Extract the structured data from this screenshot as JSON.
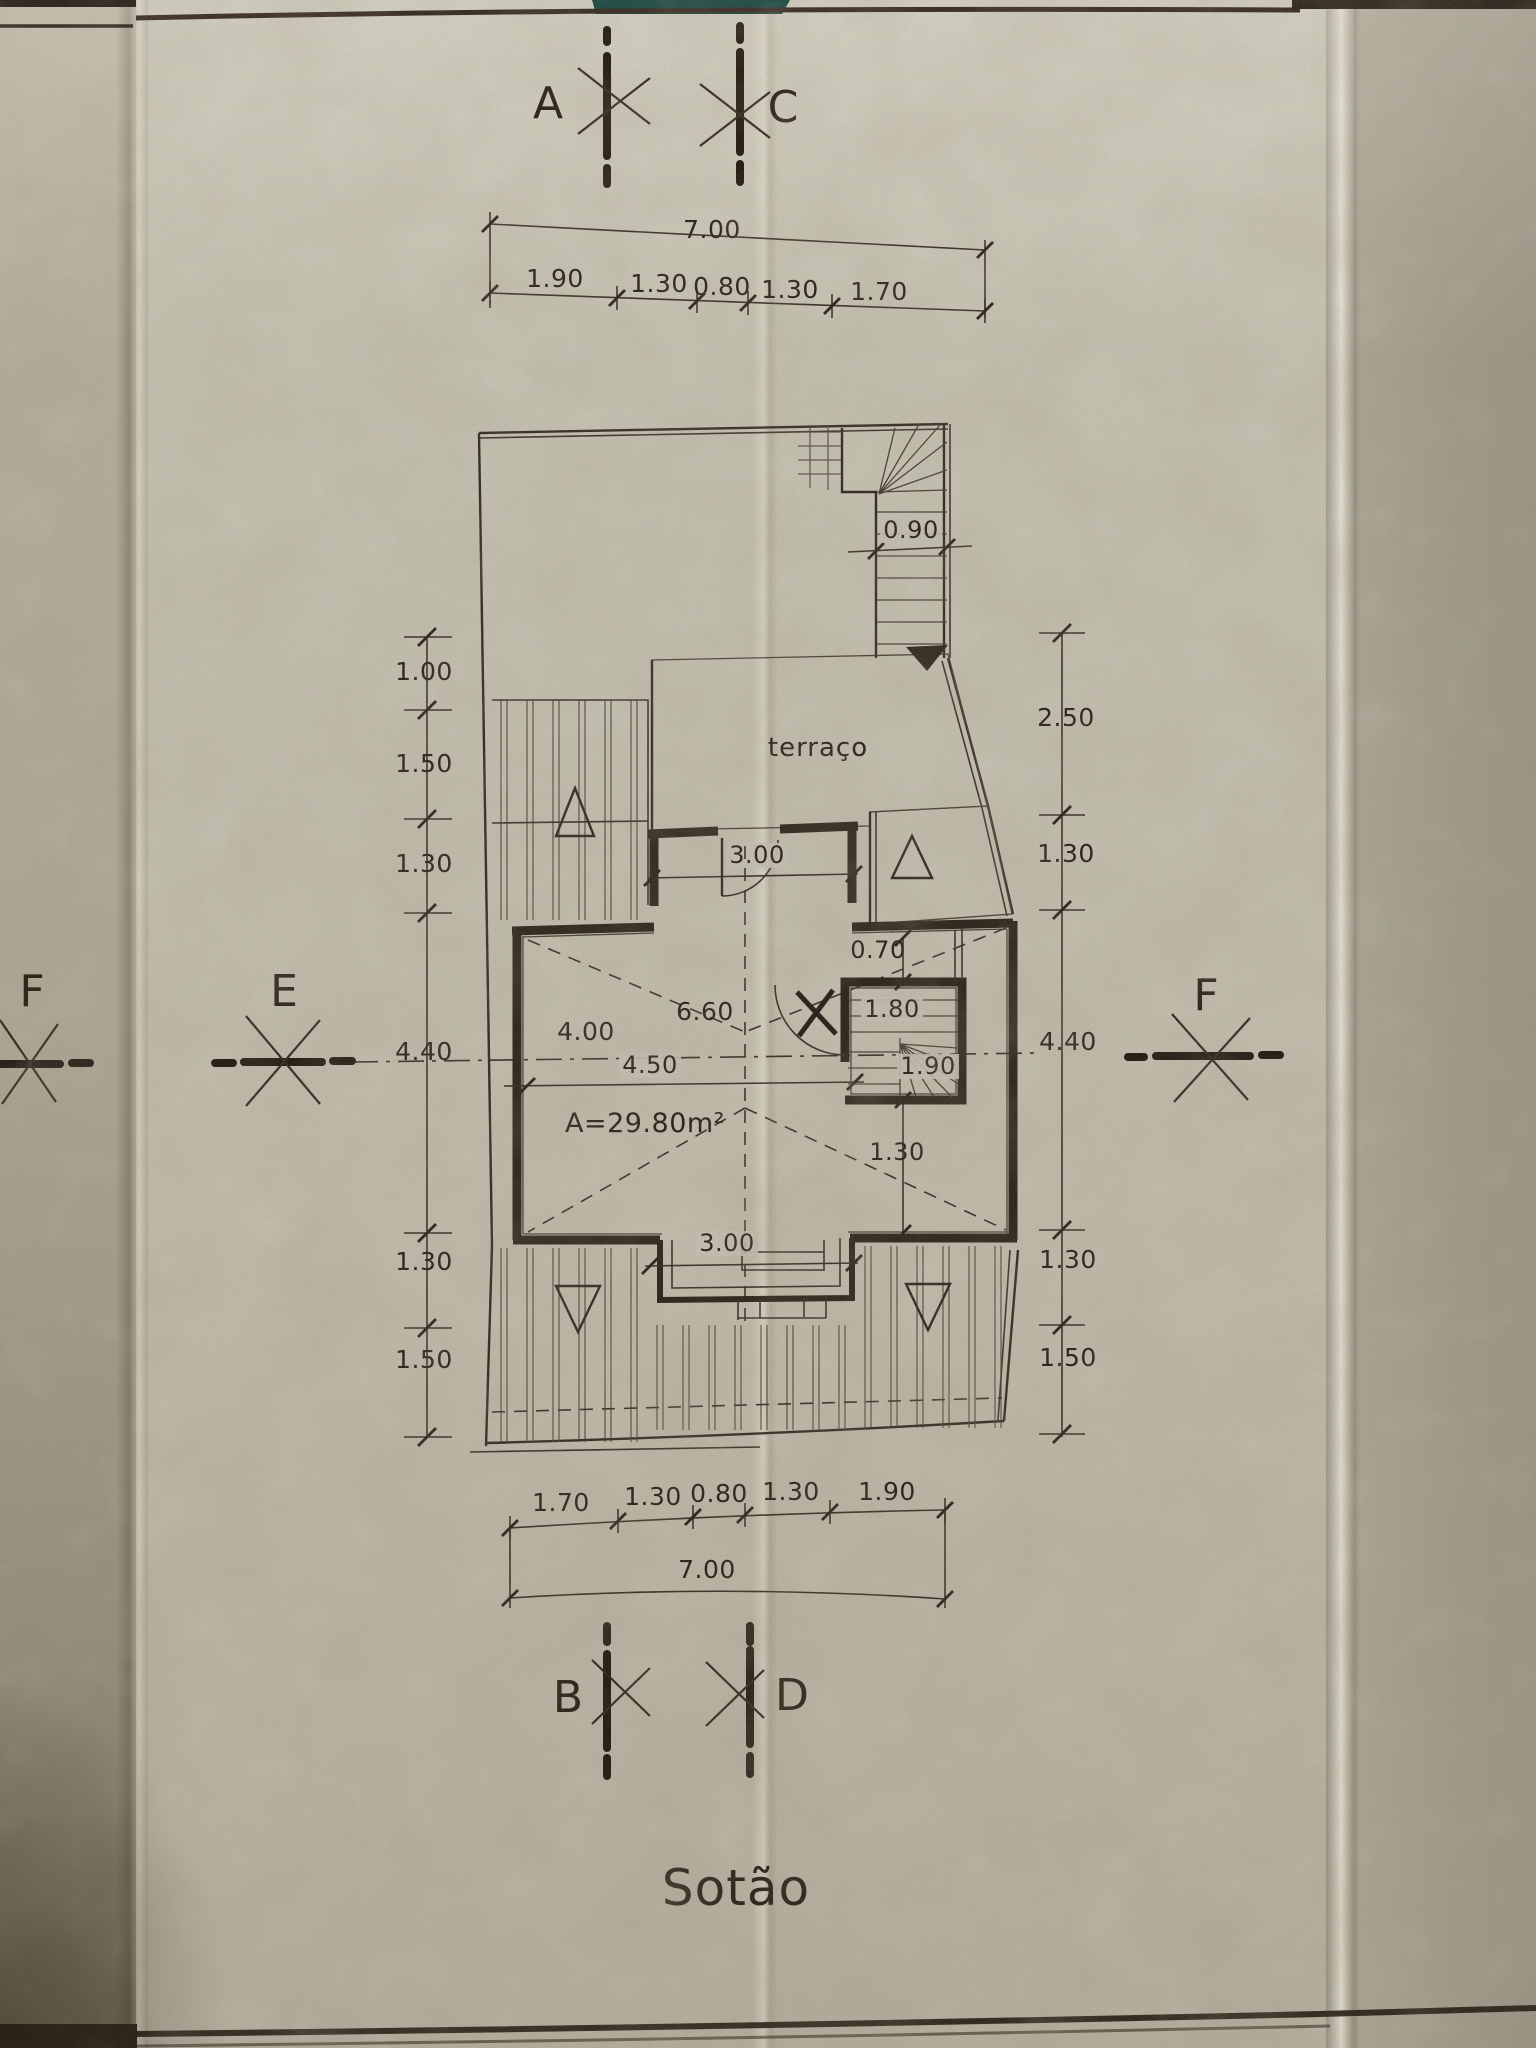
{
  "drawing": {
    "title": "Sotão",
    "markers": {
      "top_left": "A",
      "top_right": "C",
      "bottom_left": "B",
      "bottom_right": "D",
      "left_outer": "F",
      "left_inner": "E",
      "right": "F"
    },
    "dims_top": {
      "total": "7.00",
      "segments": [
        "1.90",
        "1.30",
        "0.80",
        "1.30",
        "1.70"
      ]
    },
    "dims_bottom": {
      "total": "7.00",
      "segments": [
        "1.70",
        "1.30",
        "0.80",
        "1.30",
        "1.90"
      ]
    },
    "dims_left": [
      "1.00",
      "1.50",
      "1.30",
      "4.40",
      "1.30",
      "1.50"
    ],
    "dims_right": [
      "2.50",
      "1.30",
      "4.40",
      "1.30",
      "1.50"
    ],
    "plan": {
      "terrace": "terraço",
      "area": "A=29.80m²",
      "stair_width": "0.90",
      "hall_width": "3.00",
      "gap": "0.70",
      "stair_a": "1.80",
      "stair_b": "1.90",
      "below_stair": "1.30",
      "left_span": "4.00",
      "full_span": "6.60",
      "mid_span": "4.50",
      "porch_width": "3.00"
    }
  }
}
